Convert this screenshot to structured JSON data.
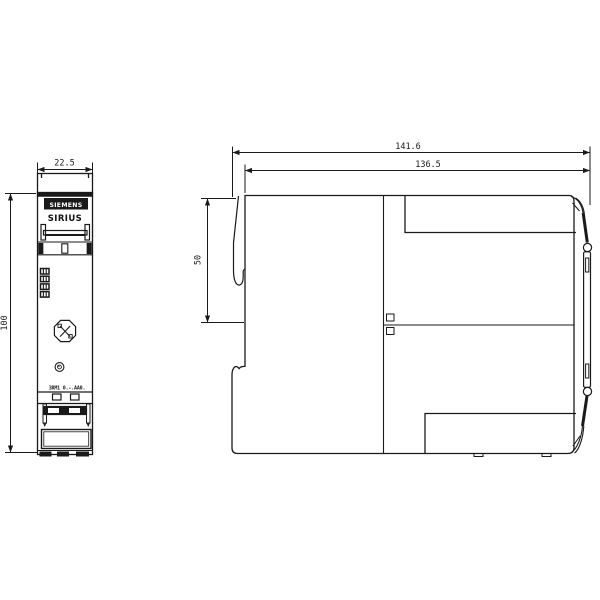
{
  "drawing": {
    "title": "SIRIUS device dimensional drawing",
    "front_view": {
      "brand": "SIEMENS",
      "product_line": "SIRIUS",
      "part_number": "3RM1 0.-.AA0.",
      "dimensions": {
        "width": "22.5",
        "height": "100"
      }
    },
    "side_view": {
      "dimensions": {
        "overall_width": "141.6",
        "body_width": "136.5",
        "upper_height": "50"
      }
    },
    "colors": {
      "line": "#1a1a1a",
      "background": "#ffffff"
    }
  }
}
